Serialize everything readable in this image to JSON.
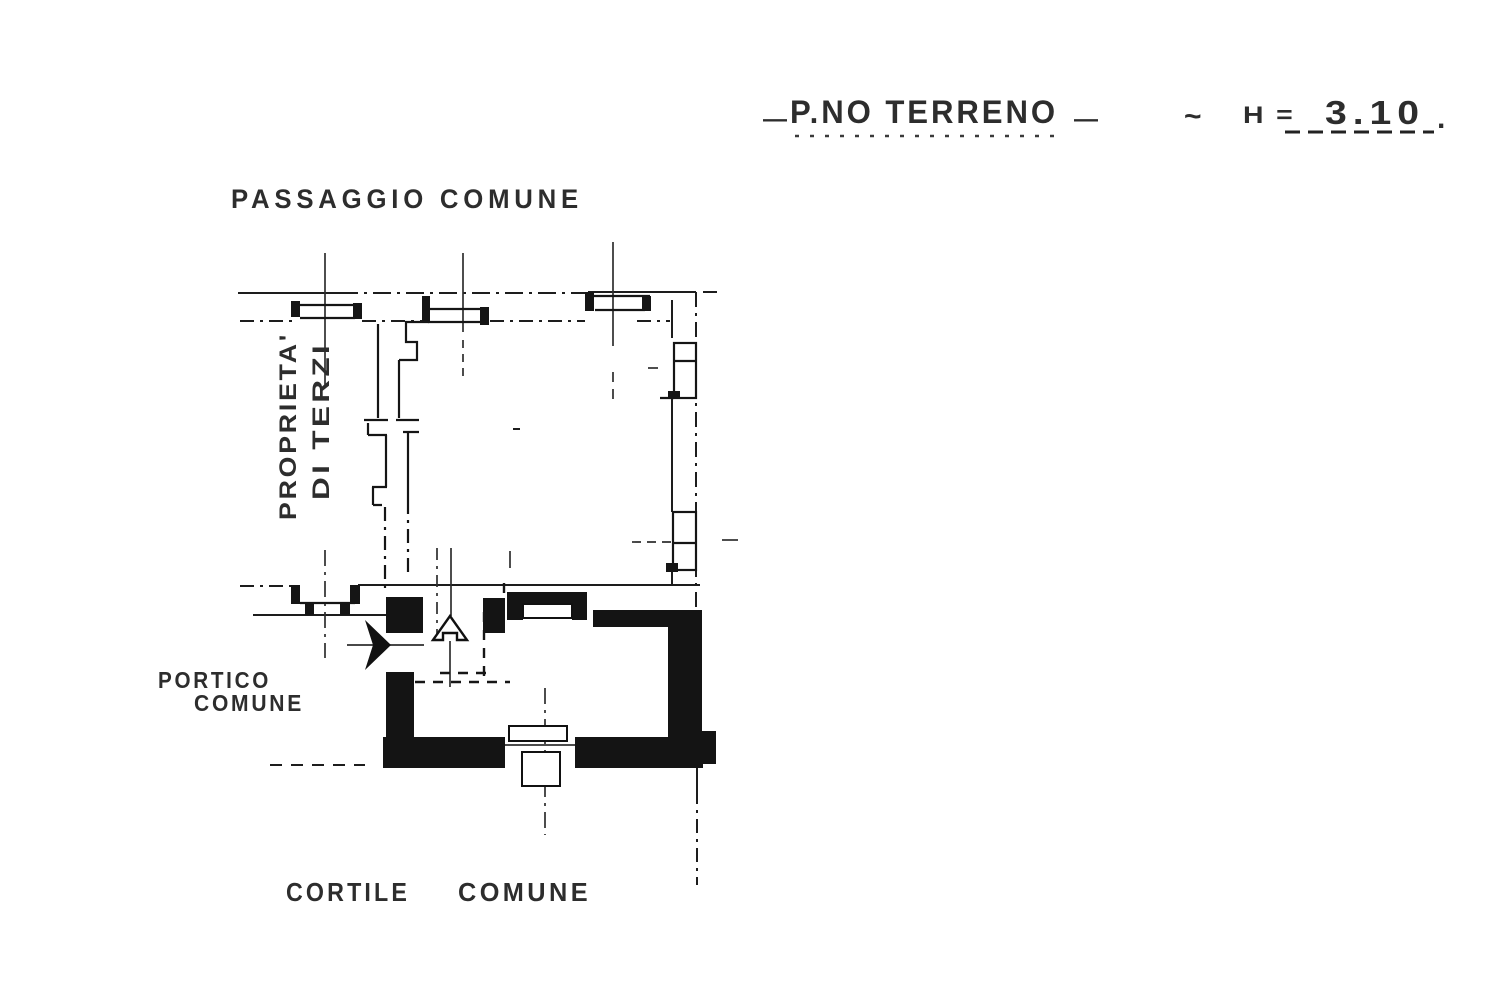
{
  "page": {
    "paper_color": "#ffffff",
    "ink_color": "#1a1a1a"
  },
  "title": {
    "prefix_mark": "—",
    "text": "P.NO TERRENO",
    "suffix_mark": "—",
    "separator": "~",
    "height_label": "H =",
    "height_value": "3.10",
    "period": "."
  },
  "labels": {
    "passaggio_comune": "PASSAGGIO COMUNE",
    "proprieta_di_terzi": {
      "line1": "PROPRIETA'",
      "line2": "DI TERZI"
    },
    "portico_comune": {
      "line1": "PORTICO",
      "line2": "COMUNE"
    },
    "cortile_comune": {
      "line1": "CORTILE",
      "line2": "COMUNE"
    }
  }
}
